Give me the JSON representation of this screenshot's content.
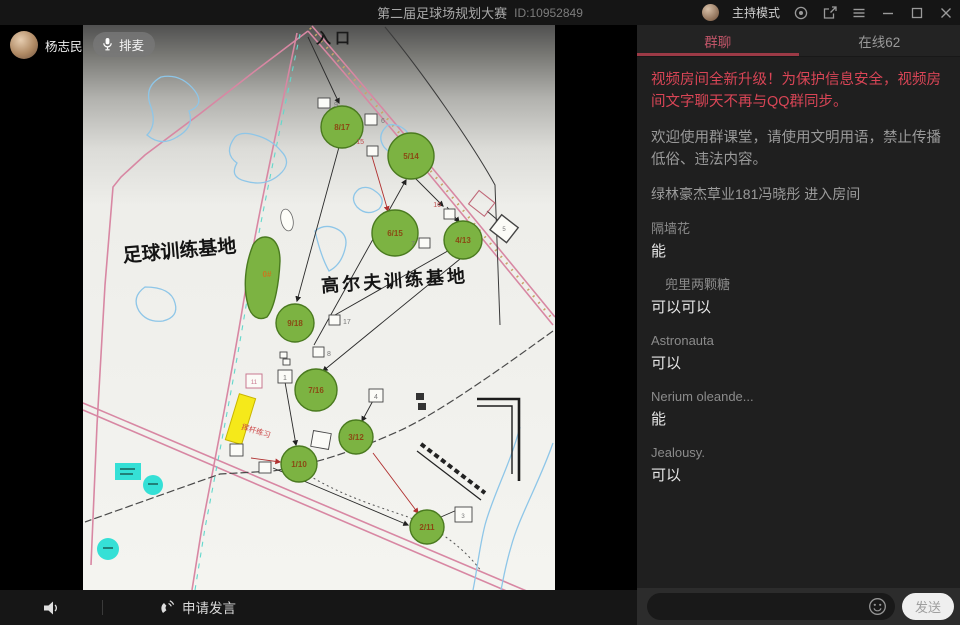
{
  "window": {
    "title": "第二届足球场规划大赛",
    "room_id": "ID:10952849",
    "mode_label": "主持模式"
  },
  "presenter": {
    "name": "杨志民",
    "mic_badge": "排麦"
  },
  "map": {
    "entrance": "入口",
    "football_zone": "足球训练基地",
    "golf_zone": "高尔夫训练基地",
    "practice_area": "挥杆练习",
    "holes": [
      "8/17",
      "5/14",
      "6/15",
      "4/13",
      "0#",
      "9/18",
      "7/16",
      "1/10",
      "3/12",
      "2/11"
    ],
    "tees": [
      "9",
      "6",
      "15",
      "16",
      "7",
      "5",
      "17",
      "8",
      "1",
      "11",
      "4",
      "3"
    ]
  },
  "chat": {
    "tab_group": "群聊",
    "tab_online": "在线62",
    "notice": "视频房间全新升级！为保护信息安全，视频房间文字聊天不再与QQ群同步。",
    "welcome": "欢迎使用群课堂，请使用文明用语，禁止传播低俗、违法内容。",
    "event": "绿林豪杰草业181冯晓彤 进入房间",
    "messages": [
      {
        "name": "隔墙花",
        "text": "能"
      },
      {
        "name": "兜里两颗糖",
        "text": "可以可以"
      },
      {
        "name": "Astronauta",
        "text": "可以"
      },
      {
        "name": "Nerium oleande...",
        "text": "能"
      },
      {
        "name": "Jealousy.",
        "text": "可以"
      }
    ],
    "send_label": "发送"
  },
  "bottom": {
    "request_speak": "申请发言"
  },
  "colors": {
    "accent_red": "#d94556",
    "tab_underline": "#9c3a46",
    "green_fill": "#7cb342",
    "yellow": "#f5e91a",
    "cyan": "#35e0d6"
  }
}
